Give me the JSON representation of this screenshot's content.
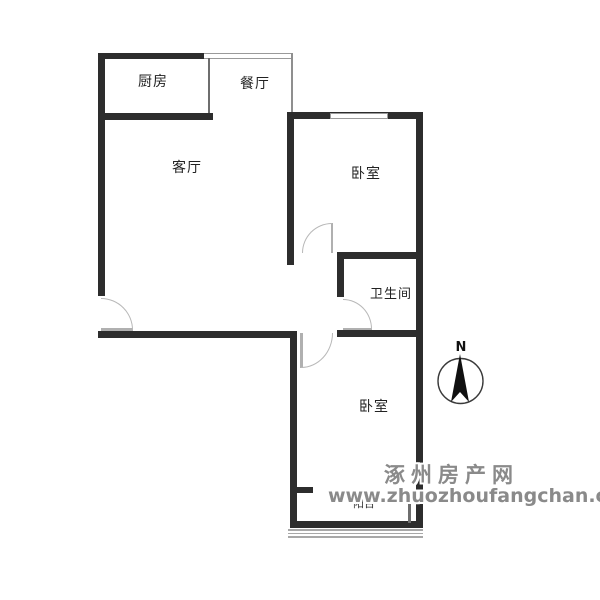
{
  "floorplan": {
    "rooms": [
      {
        "id": "kitchen",
        "label": "厨房"
      },
      {
        "id": "dining",
        "label": "餐厅"
      },
      {
        "id": "living",
        "label": "客厅"
      },
      {
        "id": "bedroom-top",
        "label": "卧室"
      },
      {
        "id": "bathroom",
        "label": "卫生间"
      },
      {
        "id": "bedroom-bottom",
        "label": "卧室"
      },
      {
        "id": "balcony",
        "label": "阳台"
      }
    ],
    "compass": {
      "north_label": "N"
    },
    "colors": {
      "wall": "#2d2d2d",
      "window_line": "#9a9a9a",
      "door_arc": "#b8b8b8",
      "label_text": "#222222",
      "watermark_text": "#8a8a8a",
      "background": "#ffffff"
    }
  },
  "watermark": {
    "line1": "涿州房产网",
    "line2": "www.zhuozhoufangchan.com"
  }
}
